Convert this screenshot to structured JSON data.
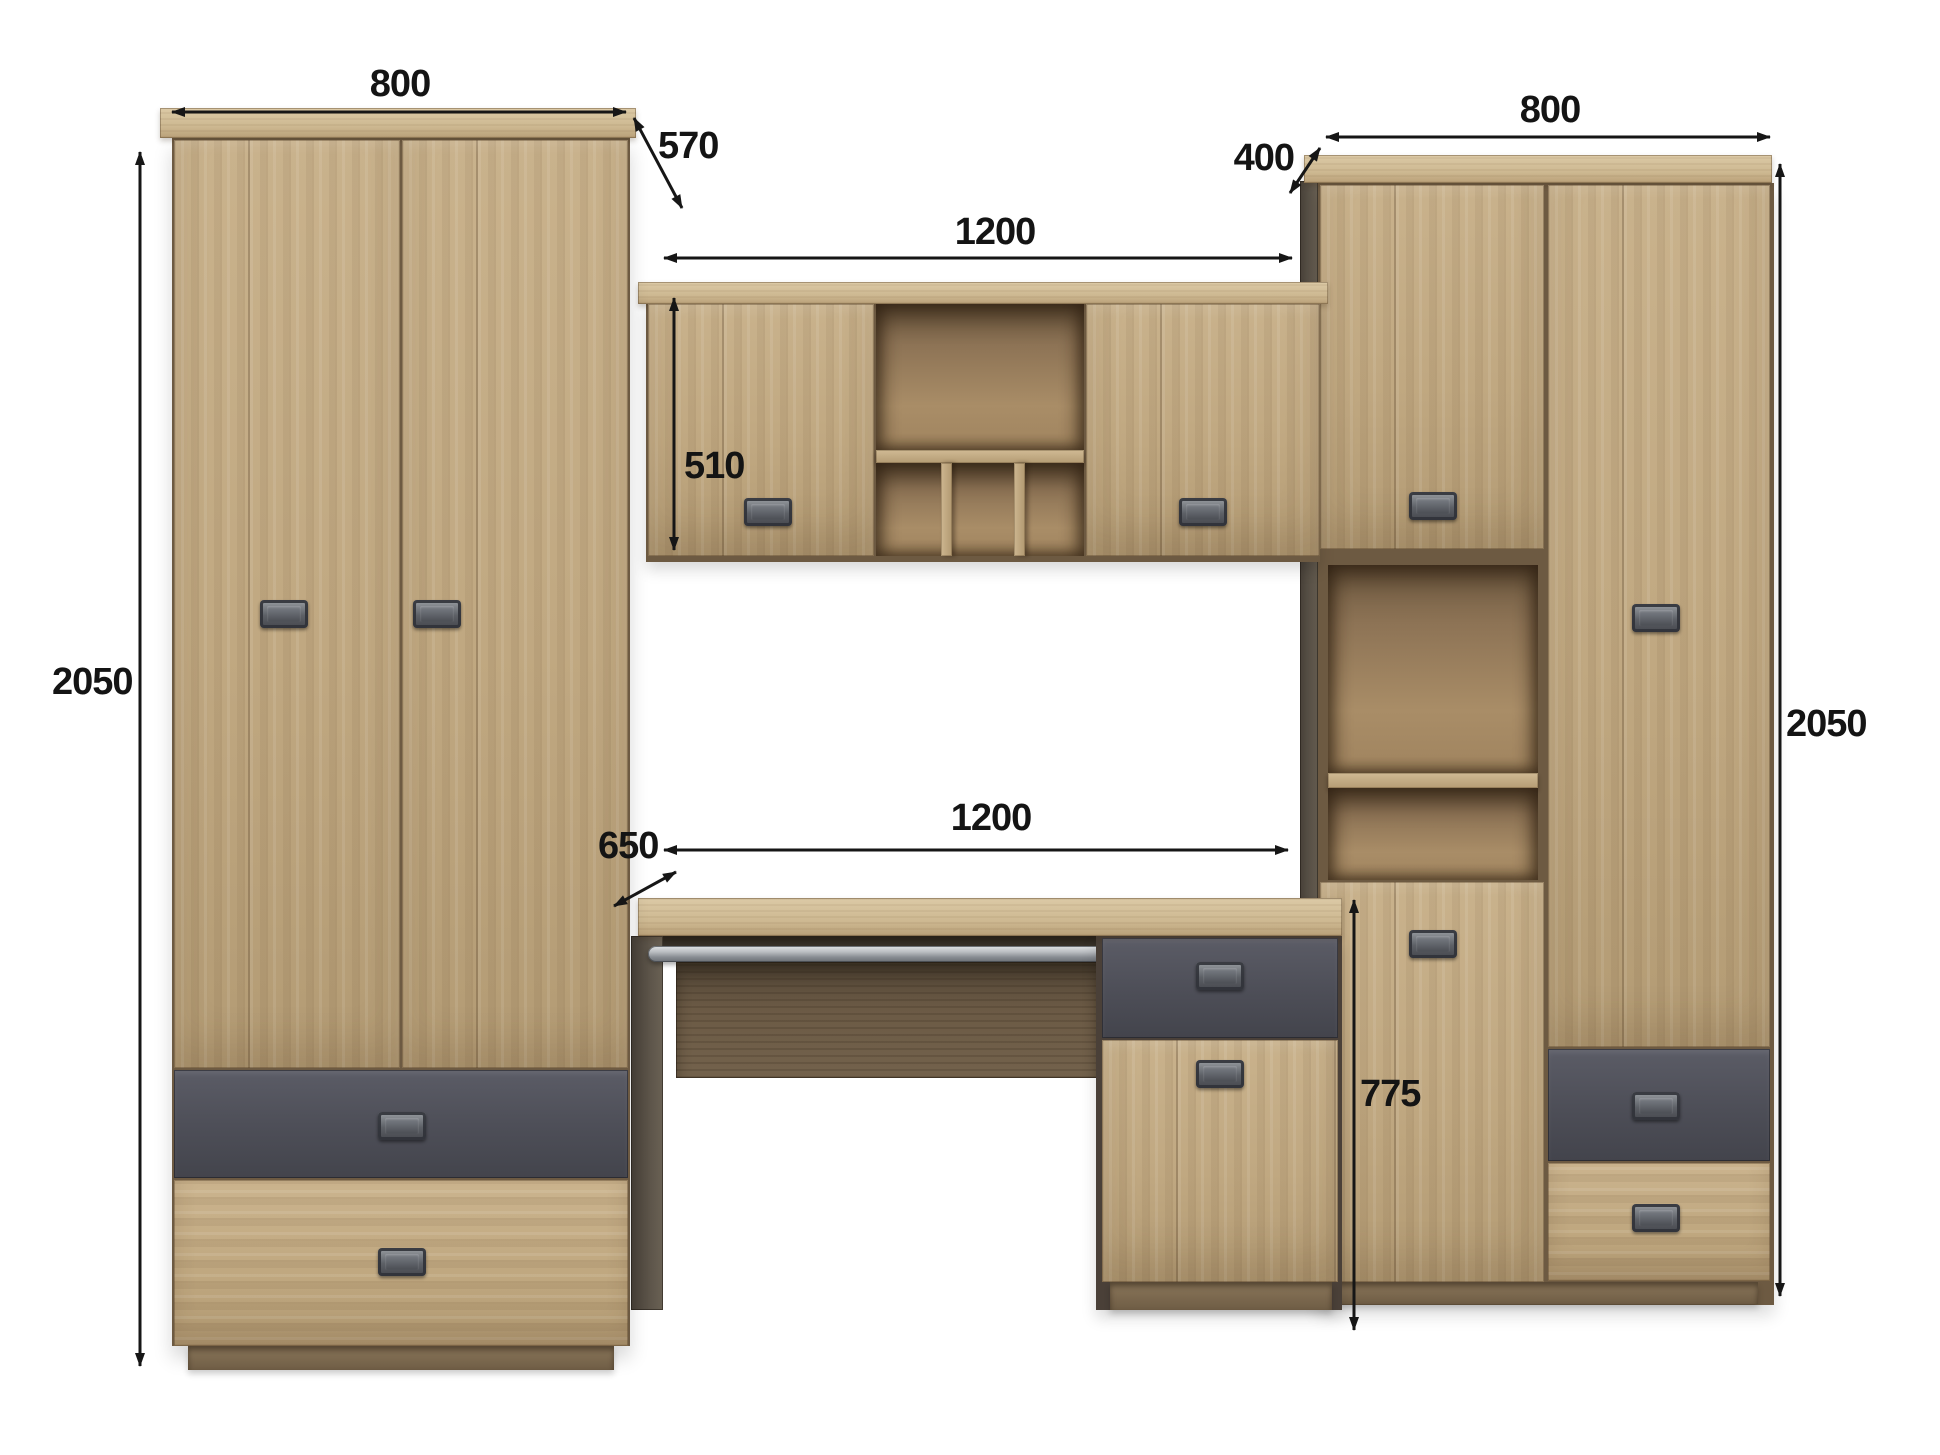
{
  "dimensions": {
    "left_wardrobe_width_mm": "800",
    "left_wardrobe_depth_mm": "570",
    "left_wardrobe_height_mm": "2050",
    "wall_hutch_width_mm": "1200",
    "wall_hutch_height_mm": "510",
    "right_cabinet_depth_mm": "400",
    "right_cabinet_width_mm": "800",
    "right_cabinet_height_mm": "2050",
    "desk_depth_mm": "650",
    "desk_width_mm": "1200",
    "desk_height_mm": "775"
  },
  "colors": {
    "wood": "#c0a881",
    "wood_light_top": "#d3c09d",
    "wood_interior": "#9a7f5e",
    "front_gray": "#4e4f58",
    "panel_brown": "#6b5a45",
    "metal": "#b9bcc0",
    "dimension_ink": "#161616",
    "background": "#ffffff"
  }
}
